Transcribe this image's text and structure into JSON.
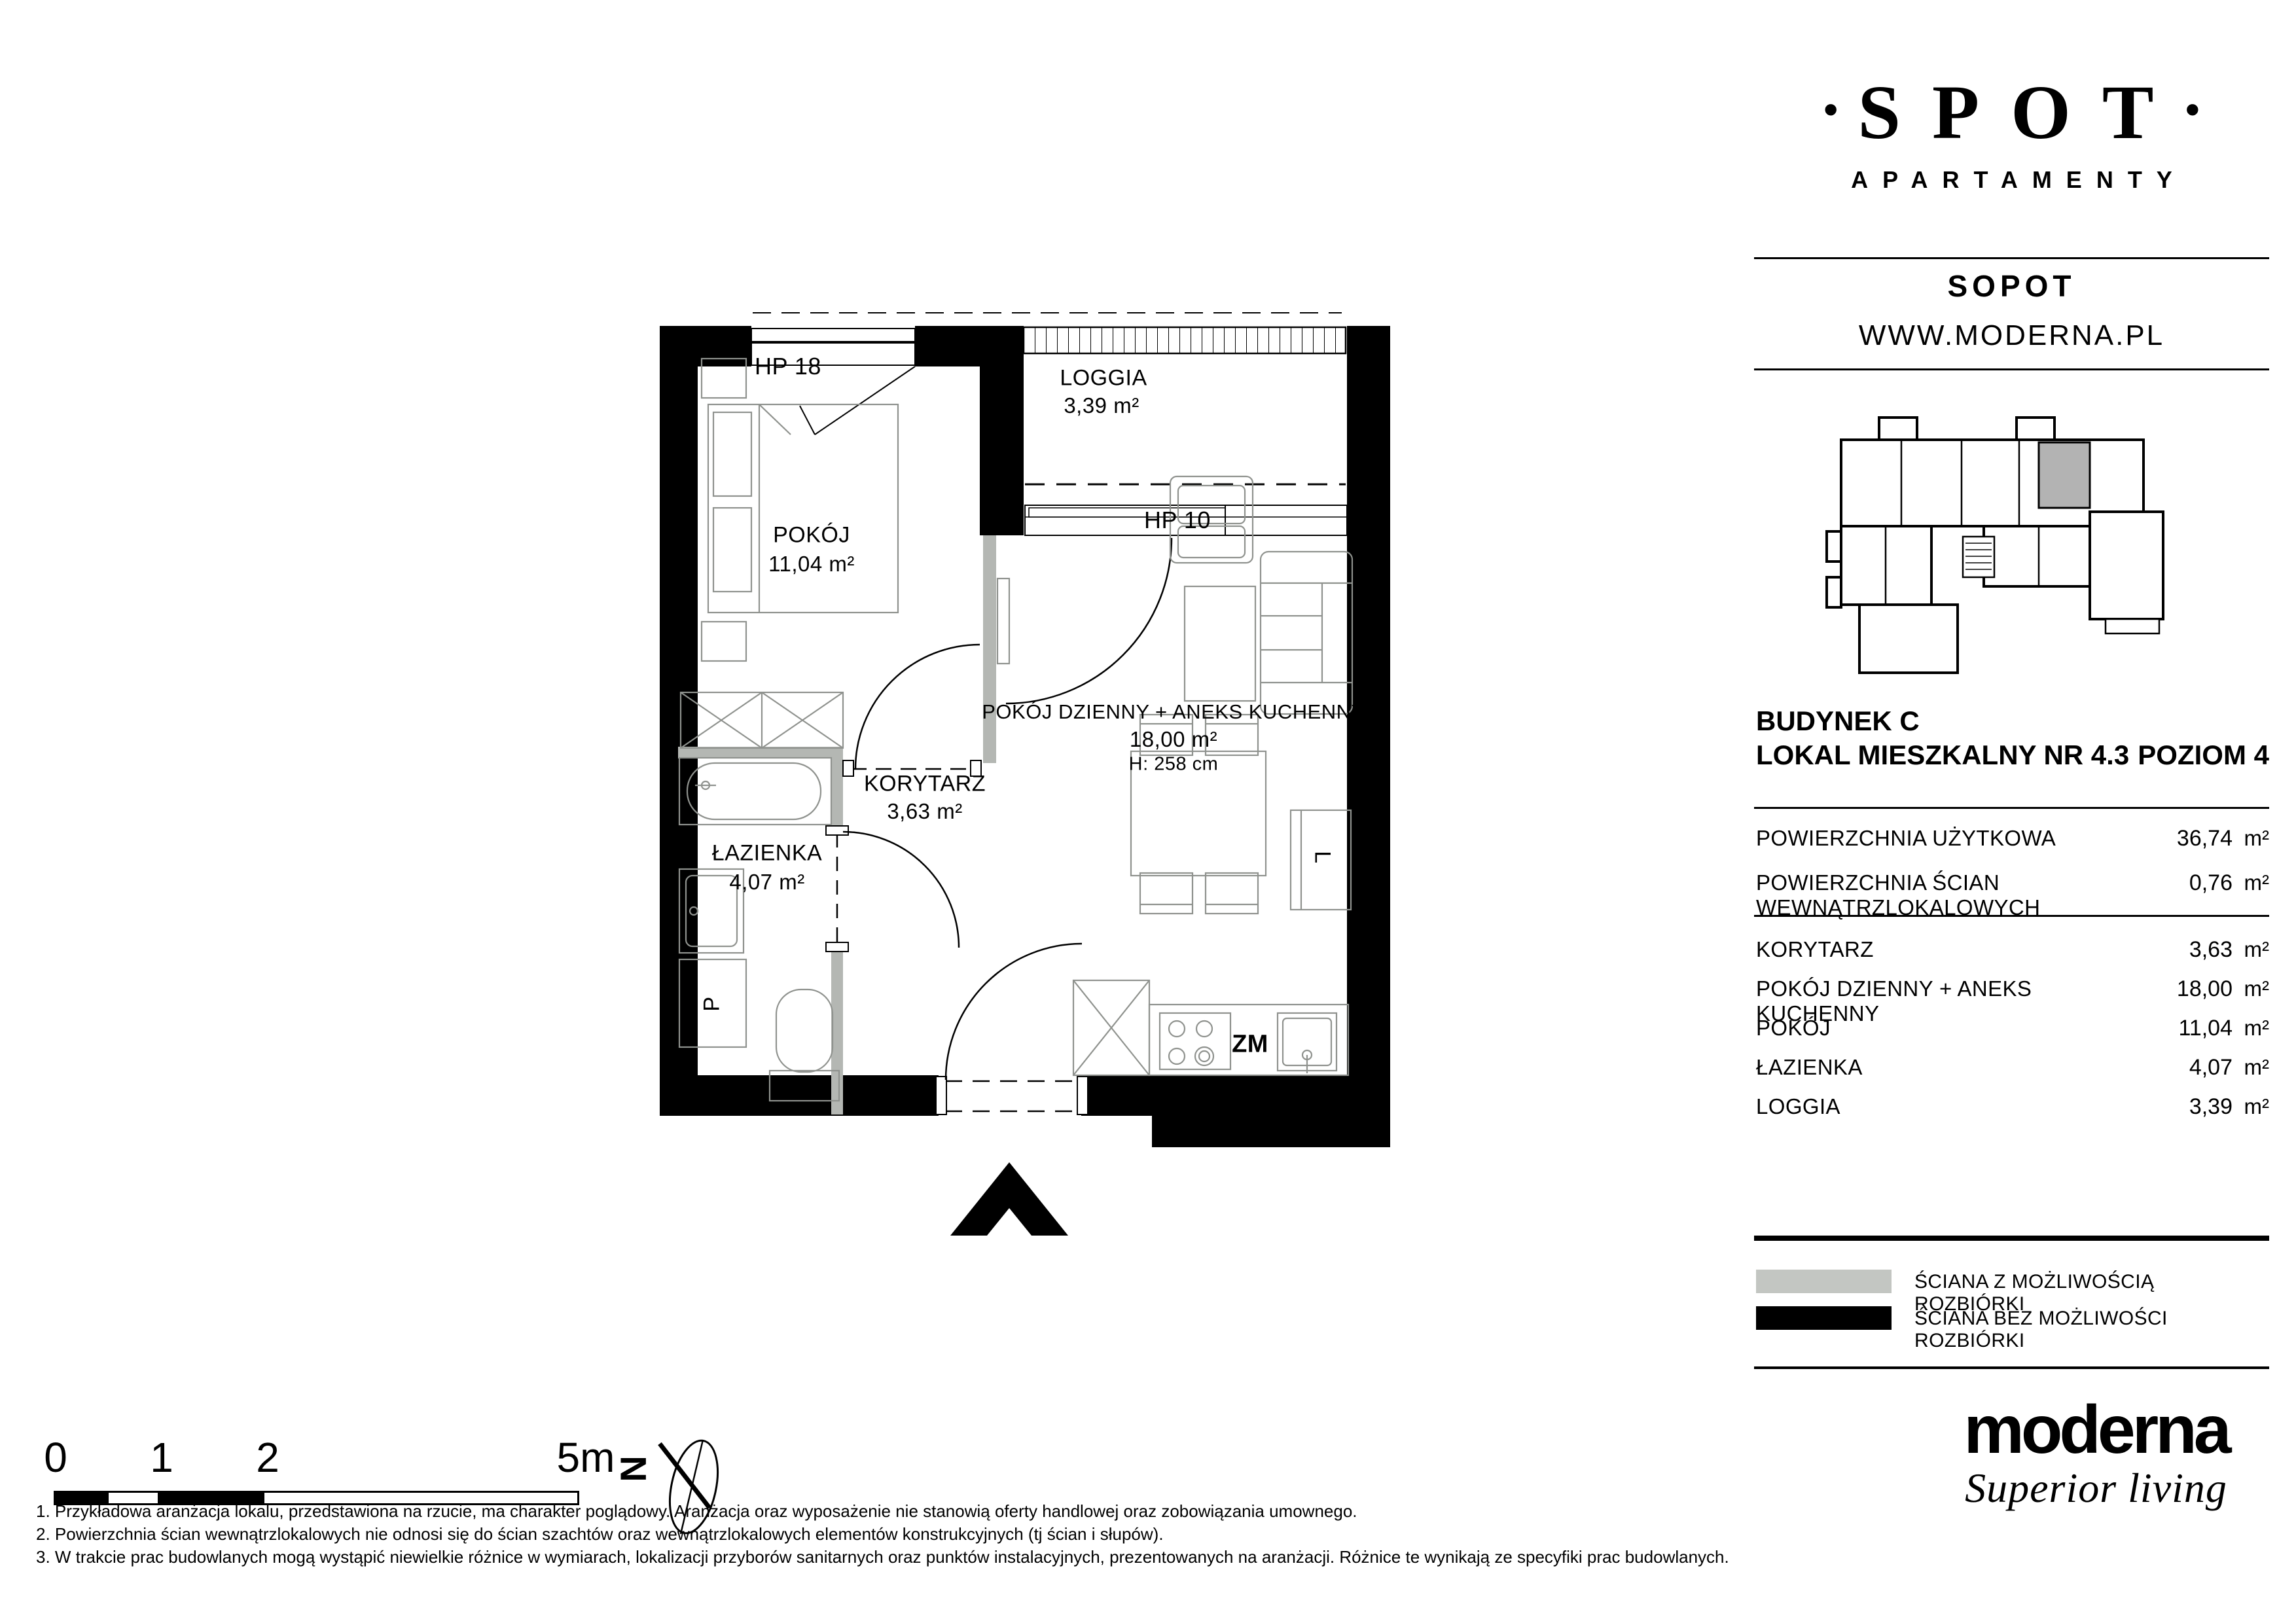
{
  "brand": {
    "dot": "•",
    "name": "SPOT",
    "subtitle": "APARTAMENTY",
    "city": "SOPOT",
    "website": "WWW.MODERNA.PL"
  },
  "unit_header": {
    "building": "BUDYNEK C",
    "unit": "LOKAL MIESZKALNY NR 4.3",
    "level": "POZIOM 4"
  },
  "summary": [
    {
      "label": "POWIERZCHNIA UŻYTKOWA",
      "value": "36,74",
      "unit": "m²"
    },
    {
      "label": "POWIERZCHNIA ŚCIAN WEWNĄTRZLOKALOWYCH",
      "value": "0,76",
      "unit": "m²"
    }
  ],
  "rooms": [
    {
      "name": "KORYTARZ",
      "area": "3,63",
      "unit": "m²"
    },
    {
      "name": "POKÓJ DZIENNY + ANEKS KUCHENNY",
      "area": "18,00",
      "unit": "m²"
    },
    {
      "name": "POKÓJ",
      "area": "11,04",
      "unit": "m²"
    },
    {
      "name": "ŁAZIENKA",
      "area": "4,07",
      "unit": "m²"
    },
    {
      "name": "LOGGIA",
      "area": "3,39",
      "unit": "m²"
    }
  ],
  "legend": [
    {
      "label": "ŚCIANA Z MOŻLIWOŚCIĄ ROZBIÓRKI",
      "color": "#c3c6c2"
    },
    {
      "label": "ŚCIANA BEZ MOŻLIWOŚCI ROZBIÓRKI",
      "color": "#000000"
    }
  ],
  "plan": {
    "hp18": "HP 18",
    "hp10": "HP 10",
    "loggia": {
      "name": "LOGGIA",
      "area": "3,39 m²"
    },
    "pokoj": {
      "name": "POKÓJ",
      "area": "11,04 m²"
    },
    "living": {
      "name": "POKÓJ DZIENNY + ANEKS KUCHENNY",
      "area": "18,00 m²",
      "height": "H: 258 cm"
    },
    "korytarz": {
      "name": "KORYTARZ",
      "area": "3,63 m²"
    },
    "lazienka": {
      "name": "ŁAZIENKA",
      "area": "4,07 m²"
    },
    "zm": "ZM",
    "p": "P",
    "l": "L"
  },
  "scalebar": {
    "ticks": [
      "0",
      "1",
      "2",
      "5m"
    ],
    "north": "N"
  },
  "footnotes": [
    "1. Przykładowa aranżacja lokalu, przedstawiona na rzucie, ma charakter poglądowy. Aranżacja oraz wyposażenie nie stanowią oferty handlowej oraz zobowiązania umownego.",
    "2. Powierzchnia ścian wewnątrzlokalowych nie odnosi się do ścian szachtów oraz wewnątrzlokalowych elementów konstrukcyjnych (tj ścian i słupów).",
    "3. W trakcie prac budowlanych mogą wystąpić niewielkie różnice w wymiarach, lokalizacji przyborów sanitarnych oraz punktów instalacyjnych, prezentowanych na aranżacji. Różnice te wynikają ze specyfiki prac budowlanych."
  ],
  "footer": {
    "logo": "moderna",
    "tagline": "Superior living"
  },
  "wall_colors": {
    "solid": "#000000",
    "removable": "#b4b7b3",
    "furniture": "#8f928e",
    "highlight_unit": "#b3b3b3"
  }
}
